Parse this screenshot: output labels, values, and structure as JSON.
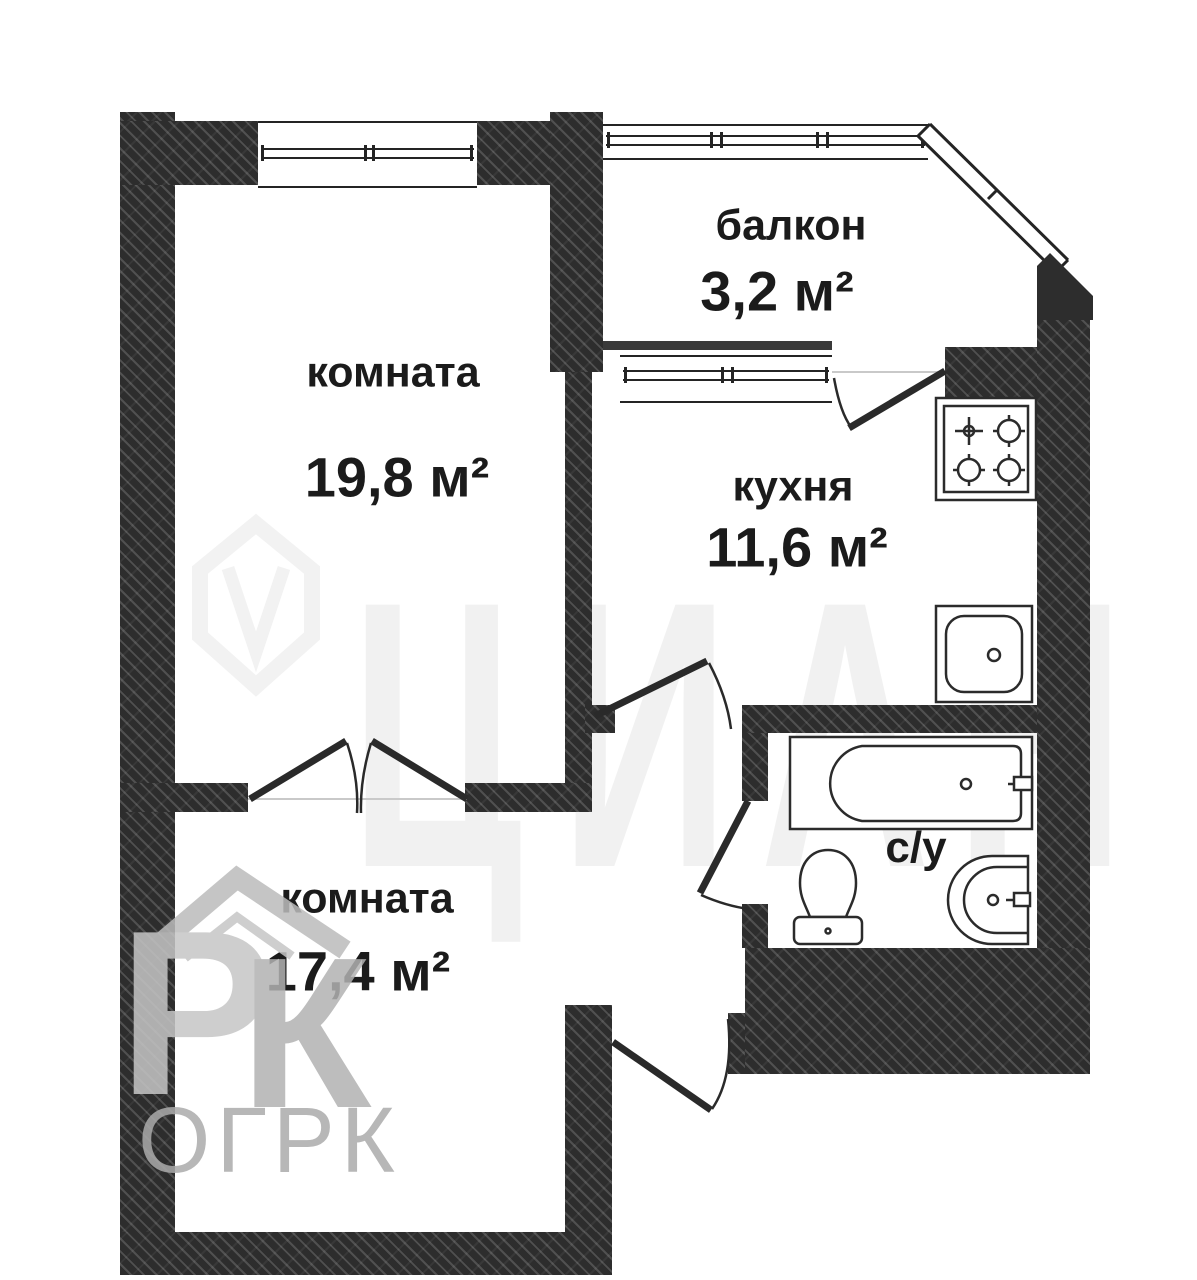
{
  "plan": {
    "type": "apartment-floor-plan",
    "rooms": [
      {
        "id": "room-top",
        "label": "комната",
        "area": "19,8 м²"
      },
      {
        "id": "balcony",
        "label": "балкон",
        "area": "3,2 м²"
      },
      {
        "id": "kitchen",
        "label": "кухня",
        "area": "11,6 м²"
      },
      {
        "id": "room-bottom",
        "label": "комната",
        "area": "17,4 м²"
      },
      {
        "id": "bathroom",
        "label": "с/у"
      }
    ],
    "fixtures": [
      "bathtub-icon",
      "toilet-icon",
      "washbasin-icon",
      "stove-icon",
      "kitchen-sink-icon"
    ],
    "colors": {
      "wall": "#2d2d2d",
      "line": "#2b2b2b",
      "text": "#1b1b1b",
      "watermark_gray": "#ababab"
    }
  },
  "watermark": {
    "agency_text": "ОГРК",
    "icon_letters": [
      "Р",
      "К"
    ],
    "background_letters": [
      "Ц",
      "И",
      "А",
      "Н"
    ]
  }
}
